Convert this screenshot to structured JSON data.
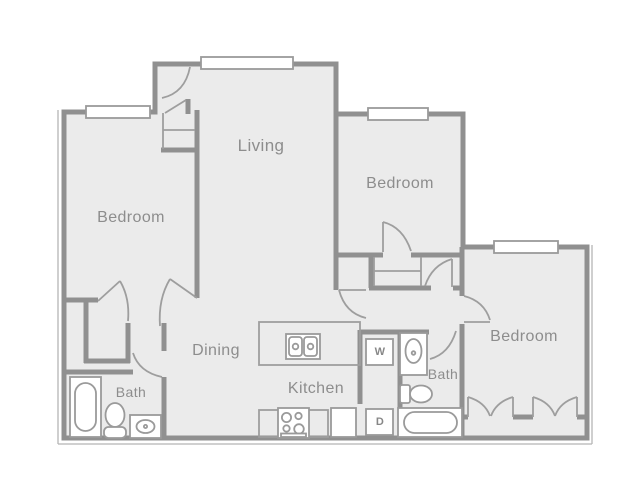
{
  "title": "Apartment floor plan",
  "rooms": {
    "living": "Living",
    "bedroom_left": "Bedroom",
    "bedroom_top_right": "Bedroom",
    "bedroom_bottom_right": "Bedroom",
    "dining": "Dining",
    "kitchen": "Kitchen",
    "bath_left": "Bath",
    "bath_right": "Bath"
  },
  "appliances": {
    "washer": "W",
    "dryer": "D"
  },
  "colors": {
    "wall": "#909090",
    "thin_line": "#9e9e9e",
    "floor": "#ebebeb",
    "fixture_fill": "#ffffff",
    "label_text": "#8d8d8d"
  }
}
